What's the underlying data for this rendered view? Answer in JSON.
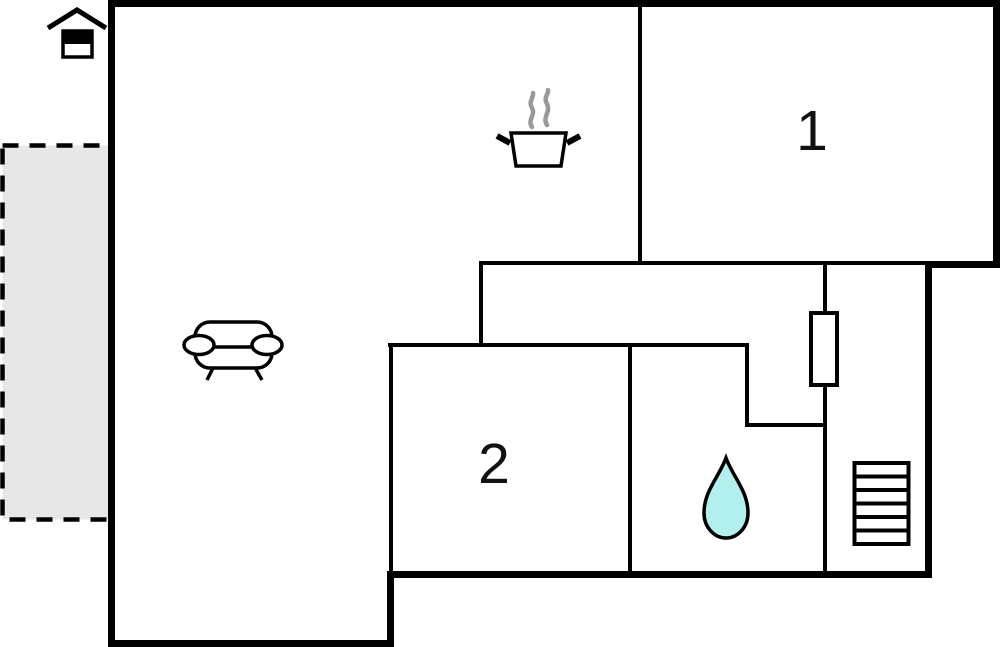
{
  "plan": {
    "title": "floor-plan",
    "rooms": [
      {
        "id": "room-1",
        "label": "1"
      },
      {
        "id": "room-2",
        "label": "2"
      }
    ],
    "areas": {
      "terrace": "terrace",
      "living_kitchen": "open living and kitchen area",
      "bathroom": "bathroom",
      "stairs": "staircase"
    },
    "icons": [
      {
        "name": "house-entrance-icon"
      },
      {
        "name": "sofa-icon"
      },
      {
        "name": "kitchen-pot-icon"
      },
      {
        "name": "steam-icon"
      },
      {
        "name": "door-icon"
      },
      {
        "name": "water-drop-icon"
      },
      {
        "name": "stairs-icon"
      }
    ],
    "colors": {
      "wall": "#000000",
      "terrace_fill": "#e7e7e7",
      "water_drop_fill": "#b2f0ee",
      "steam": "#999999",
      "background": "#ffffff"
    }
  }
}
